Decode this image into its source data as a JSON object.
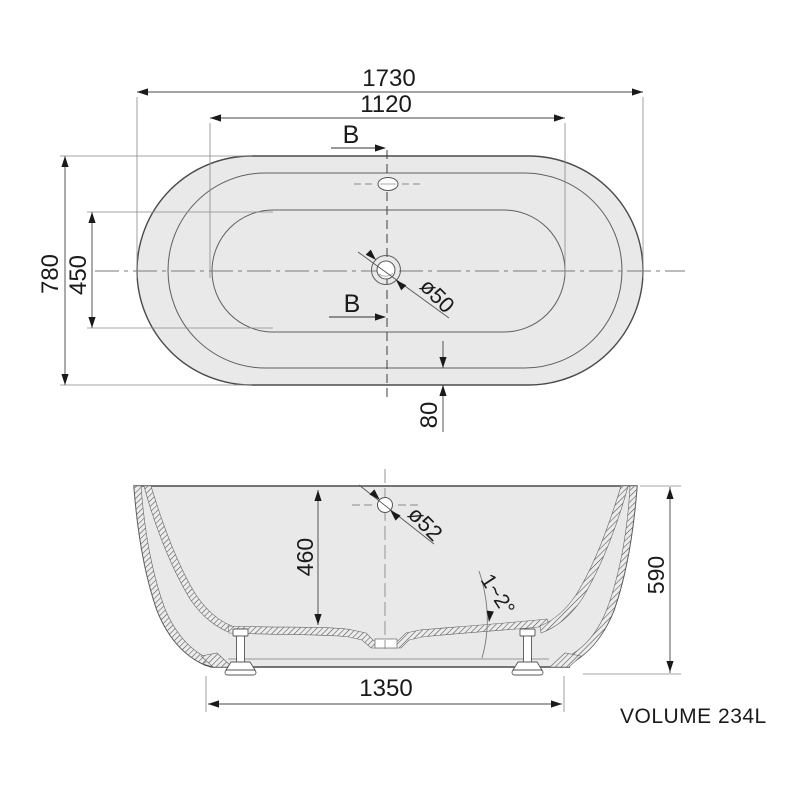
{
  "top_view": {
    "overall_length": "1730",
    "basin_length": "1120",
    "overall_width": "780",
    "basin_width": "450",
    "drain_diameter": "ø50",
    "edge_offset": "80",
    "section_marker": "B"
  },
  "side_view": {
    "inner_depth": "460",
    "overflow_diameter": "ø52",
    "floor_slope": "1~2°",
    "overall_height": "590",
    "base_length": "1350"
  },
  "volume_label": "VOLUME 234L",
  "colors": {
    "fill": "#e9e9e9",
    "outline": "#4a4a4a",
    "dimension_line": "#444444",
    "extension_line": "#888888",
    "text": "#1a1a1a"
  }
}
